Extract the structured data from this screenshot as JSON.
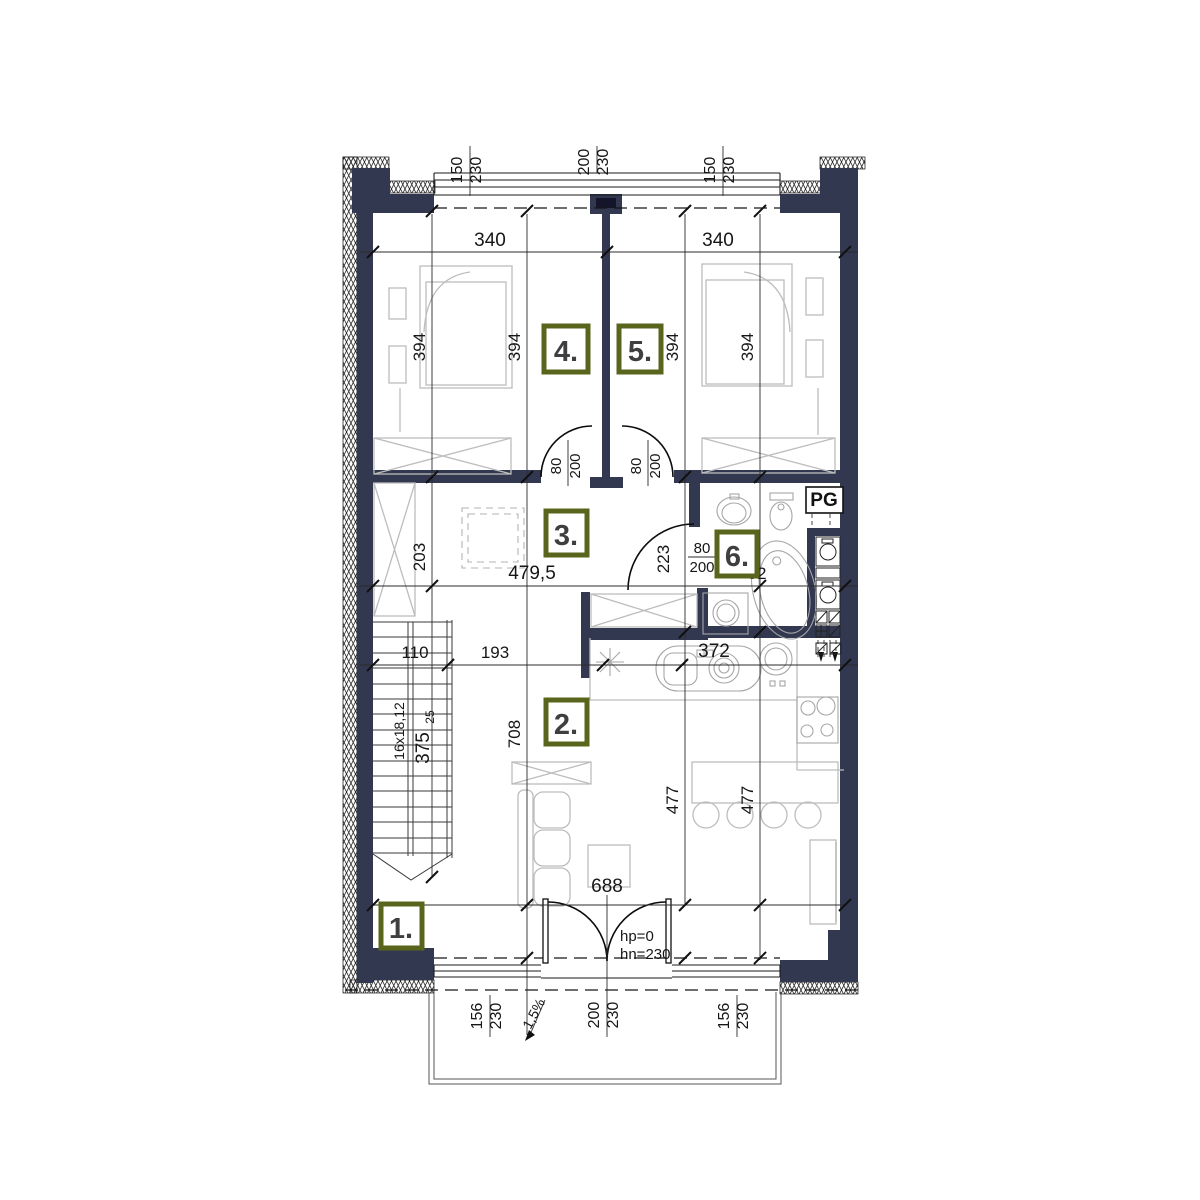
{
  "colors": {
    "wall": "#333851",
    "label_border": "#59651c",
    "furniture": "#c2c2c2",
    "dimension": "#1c1c1c"
  },
  "rooms": [
    {
      "num": "1."
    },
    {
      "num": "2."
    },
    {
      "num": "3."
    },
    {
      "num": "4."
    },
    {
      "num": "5."
    },
    {
      "num": "6."
    }
  ],
  "windows": {
    "top_left": {
      "w": "150",
      "h": "230"
    },
    "top_mid": {
      "w": "200",
      "h": "230"
    },
    "top_right": {
      "w": "150",
      "h": "230"
    },
    "bottom_left": {
      "w": "156",
      "h": "230"
    },
    "bottom_door": {
      "w": "200",
      "h": "230"
    },
    "bottom_right": {
      "w": "156",
      "h": "230"
    }
  },
  "doors": {
    "room4": {
      "w": "80",
      "h": "200"
    },
    "room5": {
      "w": "80",
      "h": "200"
    },
    "bath": {
      "w": "80",
      "h": "200"
    },
    "entry_hp": "hp=0",
    "entry_hn": "hn=230"
  },
  "dims": {
    "room4_width": "340",
    "room5_width": "340",
    "room4_depth_a": "394",
    "room4_depth_b": "394",
    "room5_depth_a": "394",
    "room5_depth_b": "394",
    "hall_depth": "203",
    "hall_width": "479,5",
    "bath_depth": "223",
    "bath_b": "215",
    "bath_c": "52",
    "chain_110": "110",
    "chain_193": "193",
    "kitchen_372": "372",
    "living_depth": "708",
    "living_a": "477",
    "living_b": "477",
    "living_width": "688",
    "entry_125": "125",
    "stairs_note": "16x18,12",
    "stairs_run": "375",
    "stairs_sup": "25",
    "slope": "1,5%"
  },
  "labels": {
    "pg": "PG"
  }
}
